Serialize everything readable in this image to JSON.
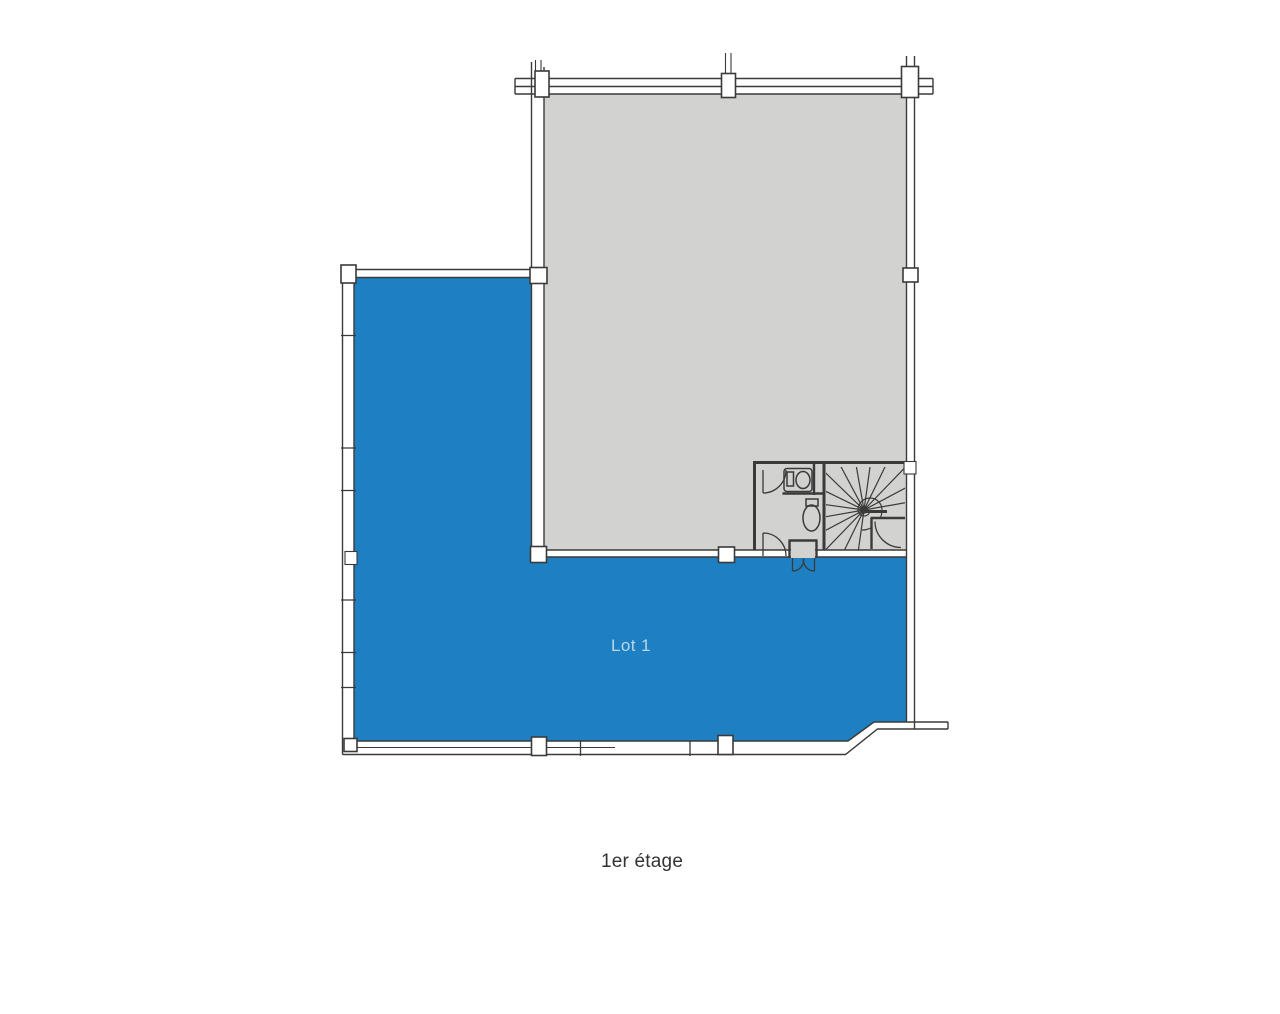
{
  "plan": {
    "lot": {
      "label": "Lot 1"
    },
    "floor_label": "1er étage"
  },
  "colors": {
    "lot_fill": "#1e80c2",
    "common_area_fill": "#d2d2d0",
    "wall_line": "#3a3a3a",
    "lot_label_text": "#b7d7eb",
    "floor_label_text": "#333333",
    "background": "#ffffff"
  }
}
